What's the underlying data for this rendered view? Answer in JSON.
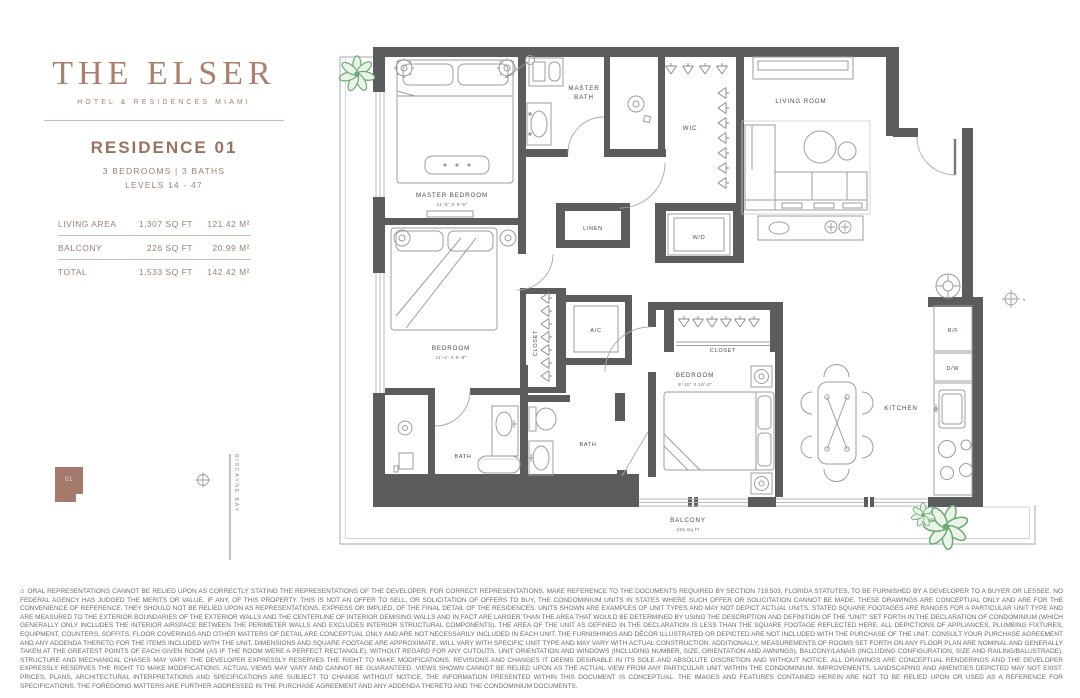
{
  "brand": {
    "name": "THE ELSER",
    "tagline": "HOTEL & RESIDENCES MIAMI"
  },
  "residence": {
    "title": "RESIDENCE 01",
    "specs": "3 BEDROOMS | 3 BATHS",
    "levels": "LEVELS 14 - 47",
    "areas": [
      {
        "label": "LIVING AREA",
        "sqft": "1,307 SQ FT",
        "sqm": "121.42 M²"
      },
      {
        "label": "BALCONY",
        "sqft": "226 SQ FT",
        "sqm": "20.99 M²"
      },
      {
        "label": "TOTAL",
        "sqft": "1,533 SQ FT",
        "sqm": "142.42 M²"
      }
    ]
  },
  "keyplan": {
    "unit_label": "01",
    "water_label": "BISCAYNE BAY"
  },
  "floorplan": {
    "rooms": {
      "master_bedroom": {
        "name": "MASTER BEDROOM",
        "dim": "11'-5\" X 9'-5\""
      },
      "master_bath": {
        "line1": "MASTER",
        "line2": "BATH"
      },
      "wic": "WIC",
      "living_room": "LIVING ROOM",
      "linen": "LINEN",
      "wd": "W/D",
      "bedroom2": {
        "name": "BEDROOM",
        "dim": "11'-4\" X 9'-8\""
      },
      "closet2": "CLOSET",
      "ac": "A/C",
      "bath1": "BATH",
      "bath2": "BATH",
      "bedroom3": {
        "name": "BEDROOM",
        "dim": "9'-10\" X 10'-2\""
      },
      "closet3": "CLOSET",
      "kitchen": "KITCHEN",
      "rf": "R/F",
      "dw": "D/W",
      "balcony": {
        "name": "BALCONY",
        "area": "226 Sq Ft"
      }
    },
    "compass_label": "N"
  },
  "icons": {
    "eho": "⌂"
  },
  "disclaimer": "ORAL REPRESENTATIONS CANNOT BE RELIED UPON AS CORRECTLY STATING THE REPRESENTATIONS OF THE DEVELOPER. FOR CORRECT REPRESENTATIONS, MAKE REFERENCE TO THE DOCUMENTS REQUIRED BY SECTION 718.503, FLORIDA STATUTES, TO BE FURNISHED BY A DEVELOPER TO A BUYER OR LESSEE. NO FEDERAL AGENCY HAS JUDGED THE MERITS OR VALUE, IF ANY, OF THIS PROPERTY. THIS IS NOT AN OFFER TO SELL, OR SOLICITATION OF OFFERS TO BUY, THE CONDOMINIUM UNITS IN STATES WHERE SUCH OFFER OR SOLICITATION CANNOT BE MADE. THESE DRAWINGS ARE CONCEPTUAL ONLY AND ARE FOR THE CONVENIENCE OF REFERENCE. THEY SHOULD NOT BE RELIED UPON AS REPRESENTATIONS, EXPRESS OR IMPLIED, OF THE FINAL DETAIL OF THE RESIDENCES. UNITS SHOWN ARE EXAMPLES OF UNIT TYPES AND MAY NOT DEPICT ACTUAL UNITS. STATED SQUARE FOOTAGES ARE RANGES FOR A PARTICULAR UNIT TYPE AND ARE MEASURED TO THE EXTERIOR BOUNDARIES OF THE EXTERIOR WALLS AND THE CENTERLINE OF INTERIOR DEMISING WALLS AND IN FACT ARE LARGER THAN THE AREA THAT WOULD BE DETERMINED BY USING THE DESCRIPTION AND DEFINITION OF THE \"UNIT\" SET FORTH IN THE DECLARATION OF CONDOMINIUM (WHICH GENERALLY ONLY INCLUDES THE INTERIOR AIRSPACE BETWEEN THE PERIMETER WALLS AND EXCLUDES INTERIOR STRUCTURAL COMPONENTS). THE AREA OF THE UNIT AS DEFINED IN THE DECLARATION IS LESS THAN THE SQUARE FOOTAGE REFLECTED HERE. ALL DEPICTIONS OF APPLIANCES, PLUMBING FIXTURES, EQUIPMENT, COUNTERS, SOFFITS, FLOOR COVERINGS AND OTHER MATTERS OF DETAIL ARE CONCEPTUAL ONLY AND ARE NOT NECESSARILY INCLUDED IN EACH UNIT. THE FURNISHINGS AND DÉCOR ILLUSTRATED OR DEPICTED ARE NOT INCLUDED WITH THE PURCHASE OF THE UNIT. CONSULT YOUR PURCHASE AGREEMENT AND ANY ADDENDA THERETO FOR THE ITEMS INCLUDED WITH THE UNIT. DIMENSIONS AND SQUARE FOOTAGE ARE APPROXIMATE, WILL VARY WITH SPECIFIC UNIT TYPE AND MAY VARY WITH ACTUAL CONSTRUCTION. ADDITIONALLY, MEASUREMENTS OF ROOMS SET FORTH ON ANY FLOOR PLAN ARE NOMINAL AND GENERALLY TAKEN AT THE GREATEST POINTS OF EACH GIVEN ROOM (AS IF THE ROOM WERE A PERFECT RECTANGLE), WITHOUT REGARD FOR ANY CUTOUTS. UNIT ORIENTATION AND WINDOWS (INCLUDING NUMBER, SIZE, ORIENTATION AND AWNINGS), BALCONY/LANAIS (INCLUDING CONFIGURATION, SIZE AND RAILING/BALUSTRADE), STRUCTURE AND MECHANICAL CHASES MAY VARY. THE DEVELOPER EXPRESSLY RESERVES THE RIGHT TO MAKE MODIFICATIONS, REVISIONS AND CHANGES IT DEEMS DESIRABLE IN ITS SOLE AND ABSOLUTE DISCRETION AND WITHOUT NOTICE. ALL DRAWINGS ARE CONCEPTUAL RENDERINGS AND THE DEVELOPER EXPRESSLY RESERVES THE RIGHT TO MAKE MODIFICATIONS. ACTUAL VIEWS MAY VARY AND CANNOT BE GUARANTEED. VIEWS SHOWN CANNOT BE RELIED UPON AS THE ACTUAL VIEW FROM ANY PARTICULAR UNIT WITHIN THE CONDOMINIUM. IMPROVEMENTS, LANDSCAPING AND AMENITIES DEPICTED MAY NOT EXIST. PRICES, PLANS, ARCHITECTURAL INTERPRETATIONS AND SPECIFICATIONS ARE SUBJECT TO CHANGE WITHOUT NOTICE. THE INFORMATION PRESENTED WITHIN THIS DOCUMENT IS CONCEPTUAL. THE IMAGES AND FEATURES CONTAINED HEREIN ARE NOT TO BE RELIED UPON OR USED AS A REFERENCE FOR SPECIFICATIONS. THE FOREGOING MATTERS ARE FURTHER ADDRESSED IN THE PURCHASE AGREEMENT AND ANY ADDENDA THERETO AND THE CONDOMINIUM DOCUMENTS."
}
